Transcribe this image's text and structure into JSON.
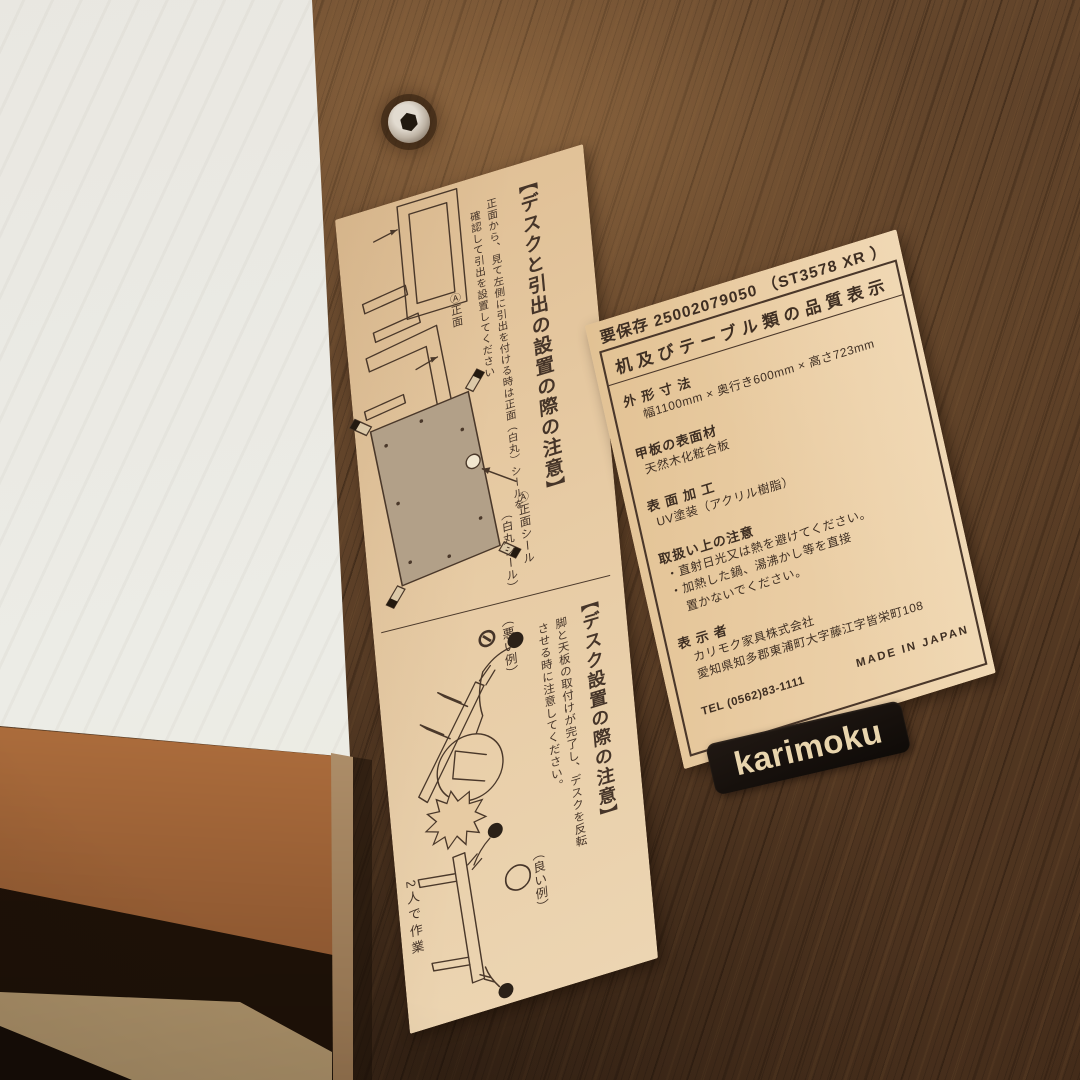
{
  "colors": {
    "walnut_wood": "#5a3e27",
    "paper": "#e7cba3",
    "ink": "#453428",
    "logo_plate_bg": "#16100c",
    "logo_text": "#e9d5ad",
    "white_panel": "#eae8e2",
    "rail_wood": "#c07a43"
  },
  "icons": {
    "screw": "hex-socket-screw",
    "bad_mark": "prohibited-circle-slash",
    "good_mark": "ok-circle"
  },
  "left_label": {
    "section1": {
      "title": "【デスクと引出の設置の際の注意】",
      "body_col1": "正面から、見て左側に引出を付ける時は正面（白丸）シールを",
      "body_col2": "確認して引出を設置してください",
      "diagram1_callout": "Ⓐ正面",
      "diagram2_callout": "Ⓐ正面",
      "sticker_callout_col1": "Ⓐ正面シール",
      "sticker_callout_col2": "（白丸シール）"
    },
    "section2": {
      "title": "【デスク設置の際の注意】",
      "body_col1": "脚と天板の取付けが完了し、デスクを反転",
      "body_col2": "させる時に注意してください。",
      "bad_label": "（悪い例）",
      "bad_mark": "⊘",
      "good_label": "（良い例）",
      "good_mark": "◯",
      "caption": "2人で作業"
    }
  },
  "right_label": {
    "header": "要保存 25002079050 （ST3578 XR ）",
    "title": "机及びテーブル類の品質表示",
    "rows": [
      {
        "label": "外 形 寸 法",
        "value": "幅1100mm × 奥行き600mm × 高さ723mm"
      },
      {
        "label": "甲板の表面材",
        "value": "天然木化粧合板"
      },
      {
        "label": "表 面 加 工",
        "value": "UV塗装（アクリル樹脂）"
      },
      {
        "label": "取扱い上の注意",
        "value": "・直射日光又は熱を避けてください。\n・加熱した鍋、湯沸かし等を直接\n　置かないでください。"
      },
      {
        "label": "表 示 者",
        "value": "カリモク家具株式会社\n愛知県知多郡東浦町大字藤江字皆栄町108"
      }
    ],
    "tel": "TEL (0562)83-1111",
    "made_in": "MADE IN JAPAN"
  },
  "logo": {
    "text": "karimoku"
  }
}
